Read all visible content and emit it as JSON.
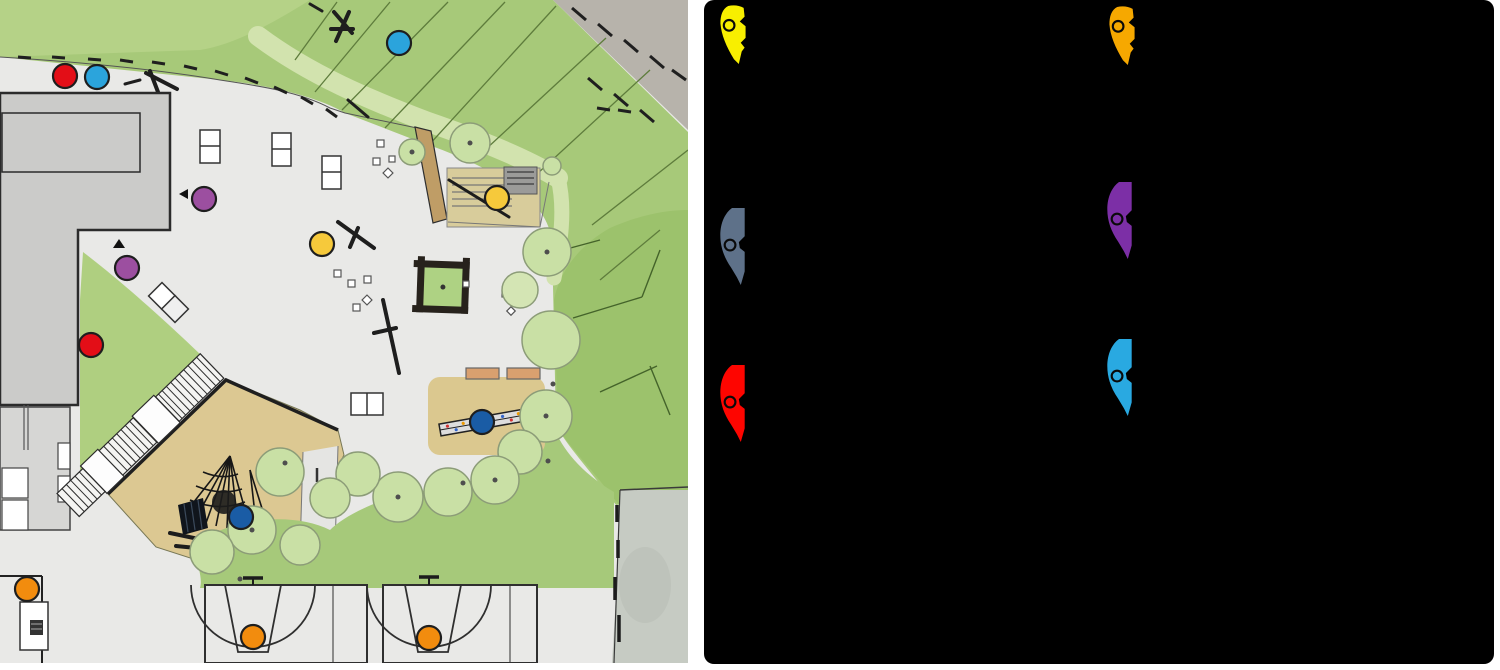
{
  "app": {
    "background": "#ffffff"
  },
  "map": {
    "kind": "playground-site-plan",
    "marker_style": {
      "radius": 12,
      "outline": "#1e1e1e"
    },
    "palette": {
      "plaza": "#E9E9E7",
      "grass": "#A7C979",
      "grass_light": "#B5D287",
      "grass_deep": "#9CC26C",
      "canopy": "#C9E0A5",
      "rocky": "#B7B3AB",
      "sand_tan": "#DCC892",
      "path_brown": "#BF9D66",
      "building": "#CBCBC9",
      "court": "#E9E9E7",
      "side_path": "#C6CBC3"
    },
    "markers": [
      {
        "id": 1,
        "color": "red",
        "hex": "#E30E17",
        "x": 65,
        "y": 76
      },
      {
        "id": 2,
        "color": "lightblue",
        "hex": "#2BA4DC",
        "x": 97,
        "y": 77
      },
      {
        "id": 3,
        "color": "lightblue",
        "hex": "#2BA4DC",
        "x": 399,
        "y": 43
      },
      {
        "id": 4,
        "color": "purple",
        "hex": "#9C4FA0",
        "x": 204,
        "y": 199
      },
      {
        "id": 5,
        "color": "yellow",
        "hex": "#F6C93B",
        "x": 322,
        "y": 244
      },
      {
        "id": 6,
        "color": "yellow",
        "hex": "#F6C93B",
        "x": 497,
        "y": 198
      },
      {
        "id": 7,
        "color": "purple",
        "hex": "#9C4FA0",
        "x": 127,
        "y": 268
      },
      {
        "id": 8,
        "color": "red",
        "hex": "#E30E17",
        "x": 91,
        "y": 345
      },
      {
        "id": 9,
        "color": "navy",
        "hex": "#1A5CA5",
        "x": 482,
        "y": 422
      },
      {
        "id": 10,
        "color": "navy",
        "hex": "#1A5CA5",
        "x": 241,
        "y": 517
      },
      {
        "id": 11,
        "color": "orange",
        "hex": "#F28C0E",
        "x": 27,
        "y": 589
      },
      {
        "id": 12,
        "color": "orange",
        "hex": "#F28C0E",
        "x": 253,
        "y": 637
      },
      {
        "id": 13,
        "color": "orange",
        "hex": "#F28C0E",
        "x": 429,
        "y": 638
      }
    ]
  },
  "legend": {
    "background": "#000000",
    "items": [
      {
        "name": "yellow-pin",
        "color": "#F8EF00",
        "x": 719,
        "y": 5,
        "variant": "small"
      },
      {
        "name": "amber-pin",
        "color": "#F6A800",
        "x": 1108,
        "y": 6,
        "variant": "small"
      },
      {
        "name": "slate-pin",
        "color": "#5E7189",
        "x": 719,
        "y": 207,
        "variant": "tall"
      },
      {
        "name": "purple-pin",
        "color": "#7C2FA6",
        "x": 1106,
        "y": 181,
        "variant": "tall"
      },
      {
        "name": "red-pin",
        "color": "#FE0500",
        "x": 719,
        "y": 364,
        "variant": "tall"
      },
      {
        "name": "sky-pin",
        "color": "#29A9E1",
        "x": 1106,
        "y": 338,
        "variant": "tall"
      }
    ]
  }
}
